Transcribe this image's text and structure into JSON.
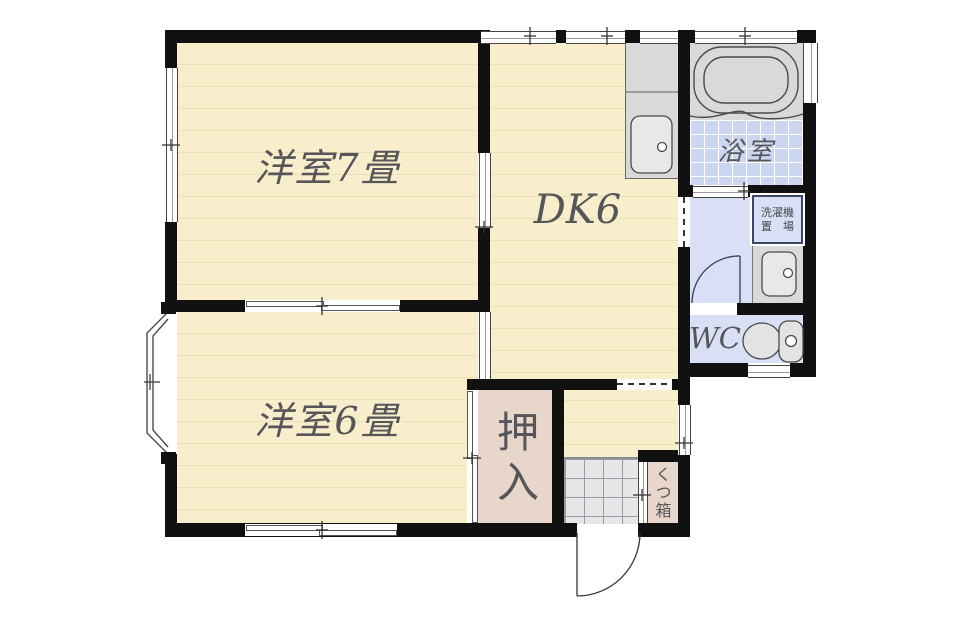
{
  "title": "apartment-floor-plan",
  "rooms": {
    "western7": {
      "label": "洋室7畳"
    },
    "western6": {
      "label": "洋室6畳"
    },
    "dk": {
      "label": "DK6"
    },
    "bath": {
      "label": "浴室"
    },
    "wc": {
      "label": "WC"
    },
    "closet": {
      "label": "押入"
    },
    "shoebox": {
      "label": "くつ箱"
    },
    "laundry": {
      "line1": "洗濯機",
      "line2": "置　場"
    }
  },
  "icons": {
    "bathtub": "bathtub-icon",
    "kitchen_sink": "kitchen-sink-icon",
    "washbasin": "washbasin-icon",
    "toilet": "toilet-icon",
    "bay_window": "bay-window",
    "entrance_door": "entrance-door-swing",
    "washroom_door": "washroom-door-swing"
  },
  "colors": {
    "wall": "#111111",
    "room_cream": "#f8eecb",
    "stripe": "#ecdfb6",
    "pink": "#e9d6cb",
    "bath_tile": "#cbd7f0",
    "lavender": "#d9e0f6",
    "fixture_gray": "#d9d9d9",
    "tile_gray": "#e7e7ea",
    "label": "#55555a",
    "laundry_border": "#3a4766"
  }
}
